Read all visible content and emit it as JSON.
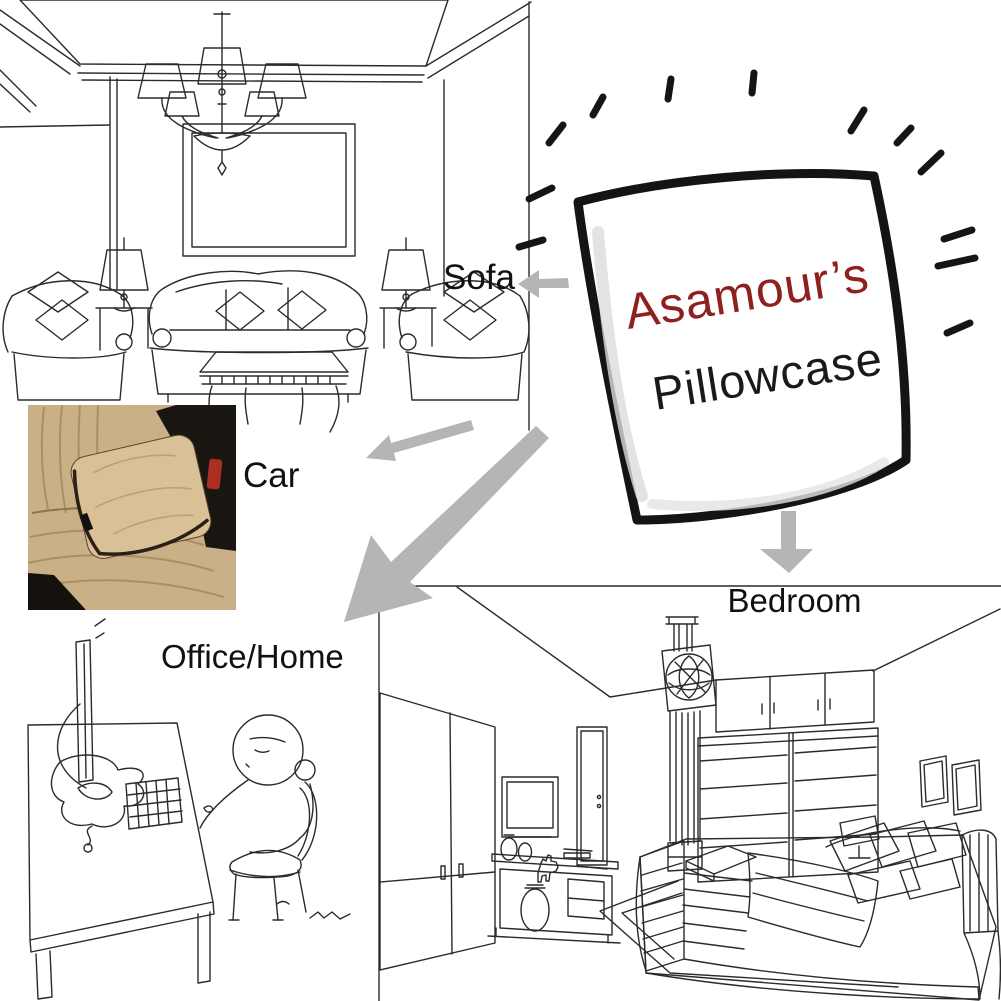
{
  "hero": {
    "brand": "Asamour’s",
    "product": "Pillowcase",
    "brand_color": "#8e2020",
    "product_color": "#1a1a1a"
  },
  "scene_labels": {
    "sofa": "Sofa",
    "car": "Car",
    "office": "Office/Home",
    "bedroom": "Bedroom"
  },
  "colors": {
    "background": "#ffffff",
    "arrow_gray": "#b3b5b6",
    "line_art": "#2b2b2b",
    "label_text": "#111111",
    "car_seat": "#c9b086",
    "car_pillow": "#d9c096",
    "car_shadow": "#17130e",
    "car_belt_red": "#ac2f22"
  },
  "icons": {
    "sofa_arrow": "arrow-left-icon",
    "car_arrow": "arrow-down-left-icon",
    "office_arrow": "arrow-down-left-icon",
    "bedroom_arrow": "arrow-down-icon",
    "sparkles": "radiating-dashes-icon"
  }
}
